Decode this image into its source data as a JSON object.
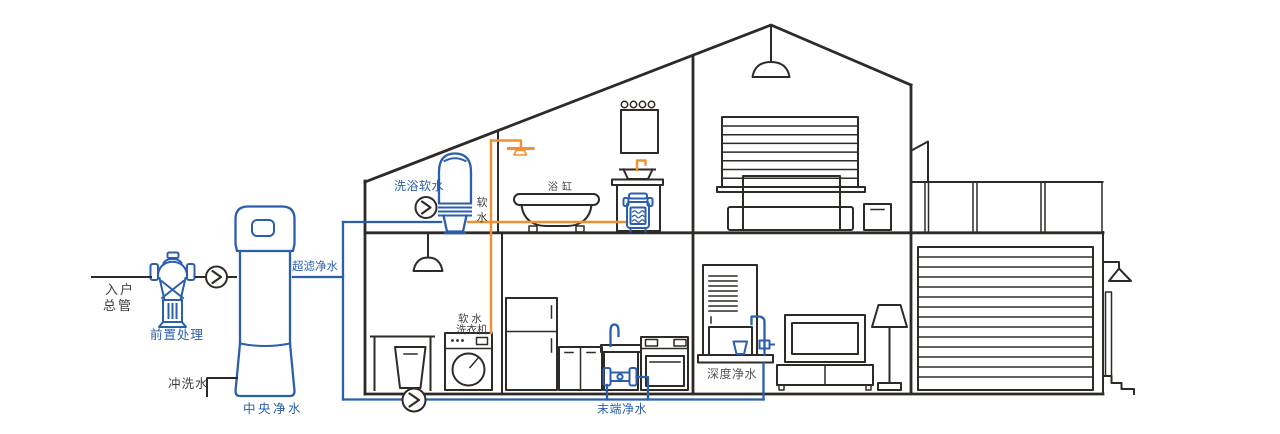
{
  "colors": {
    "line_dark": "#2e2a27",
    "pipe_blue": "#2b5fac",
    "pipe_orange": "#ef9133",
    "label_dark": "#3f3d40",
    "label_gray": "#54565b",
    "background": "#ffffff"
  },
  "icons": {
    "flow_arrow": "chevron-right-in-circle",
    "ceiling_lamp": "pendant-lamp",
    "wall_lamp": "triangle-sconce"
  },
  "labels": {
    "inlet_main": [
      "入户",
      "总管"
    ],
    "pre_treatment": "前置处理",
    "flush_water": "冲洗水",
    "central_purification": "中央净水",
    "ultrafiltration": "超滤净水",
    "bath_soft_water": "洗浴软水",
    "soft_water_vertical": [
      "软",
      "水"
    ],
    "bathtub": "浴缸",
    "soft_water_washer": [
      "软 水",
      "洗衣机"
    ],
    "terminal_purification": "末端净水",
    "deep_purification": "深度净水"
  }
}
